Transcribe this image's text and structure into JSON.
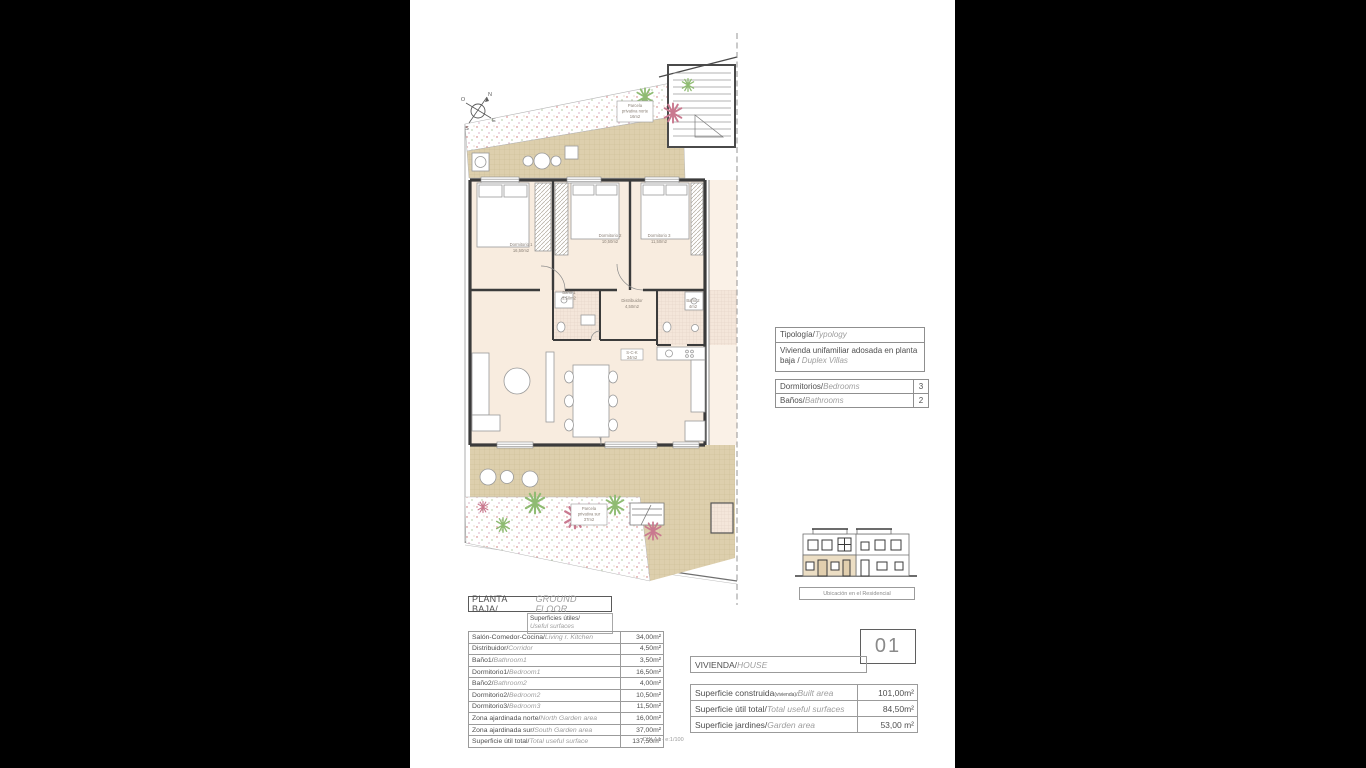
{
  "page": {
    "scale_note": "DIN A4 - e:1/100"
  },
  "compass": {
    "n": "N",
    "s": "S",
    "e": "E",
    "o": "O"
  },
  "plan": {
    "rooms": {
      "dormitorio1": {
        "name": "Dormitorio 1",
        "area": "16,50m2"
      },
      "dormitorio2": {
        "name": "Dormitorio 2",
        "area": "10,50m2"
      },
      "dormitorio3": {
        "name": "Dormitorio 3",
        "area": "11,50m2"
      },
      "bano1": {
        "name": "Baño 1",
        "area": "3,50m2"
      },
      "bano2": {
        "name": "Baño 2",
        "area": "4m2"
      },
      "distribuidor": {
        "name": "Distribuidor",
        "area": "4,50m2"
      },
      "sck": {
        "name": "S-C-K",
        "area": "34m2"
      },
      "parcela_norte": {
        "l1": "Parcela",
        "l2": "privativa norte",
        "l3": "16m2"
      },
      "parcela_sur": {
        "l1": "Parcela",
        "l2": "privativa sur",
        "l3": "37m2"
      }
    }
  },
  "typology": {
    "label_es": "Tipología/",
    "label_en": "Typology",
    "value_es": "Vivienda unifamiliar adosada en planta baja / ",
    "value_en": "Duplex Villas"
  },
  "counts": {
    "rows": [
      {
        "es": "Dormitorios/",
        "en": "Bedrooms",
        "value": "3"
      },
      {
        "es": "Baños/",
        "en": "Bathrooms",
        "value": "2"
      }
    ]
  },
  "location": {
    "caption": "Ubicación en el Residencial"
  },
  "floor": {
    "title_es": "PLANTA BAJA/",
    "title_en": "GROUND FLOOR",
    "note_es": "Superficies útiles/",
    "note_en": "Useful surfaces"
  },
  "surfaces": {
    "rows": [
      {
        "es": "Salón-Comedor-Cocina/",
        "en": "Living r. Kitchen",
        "value": "34,00m²"
      },
      {
        "es": "Distribuidor/",
        "en": "Corridor",
        "value": "4,50m²"
      },
      {
        "es": "Baño1/",
        "en": "Bathroom1",
        "value": "3,50m²"
      },
      {
        "es": "Dormitorio1/",
        "en": "Bedroom1",
        "value": "16,50m²"
      },
      {
        "es": "Baño2/",
        "en": "Bathroom2",
        "value": "4,00m²"
      },
      {
        "es": "Dormitorio2/",
        "en": "Bedroom2",
        "value": "10,50m²"
      },
      {
        "es": "Dormitorio3/",
        "en": "Bedroom3",
        "value": "11,50m²"
      },
      {
        "es": "Zona ajardinada norte/",
        "en": "North Garden area",
        "value": "16,00m²"
      },
      {
        "es": "Zona ajardinada sur/",
        "en": "South Garden area",
        "value": "37,00m²"
      },
      {
        "es": "Superficie útil total/",
        "en": "Total useful surface",
        "value": "137,50m²"
      }
    ]
  },
  "unit": {
    "number": "01",
    "header_es": "VIVIENDA/",
    "header_en": "HOUSE",
    "rows": [
      {
        "es": "Superficie construida",
        "sub": "(vivienda)/",
        "en": "Built area",
        "value": "101,00m²"
      },
      {
        "es": "Superficie útil total/",
        "sub": "",
        "en": "Total useful surfaces",
        "value": "84,50m²"
      },
      {
        "es": "Superficie jardines/",
        "sub": "",
        "en": "Garden area",
        "value": "53,00 m²"
      }
    ]
  }
}
